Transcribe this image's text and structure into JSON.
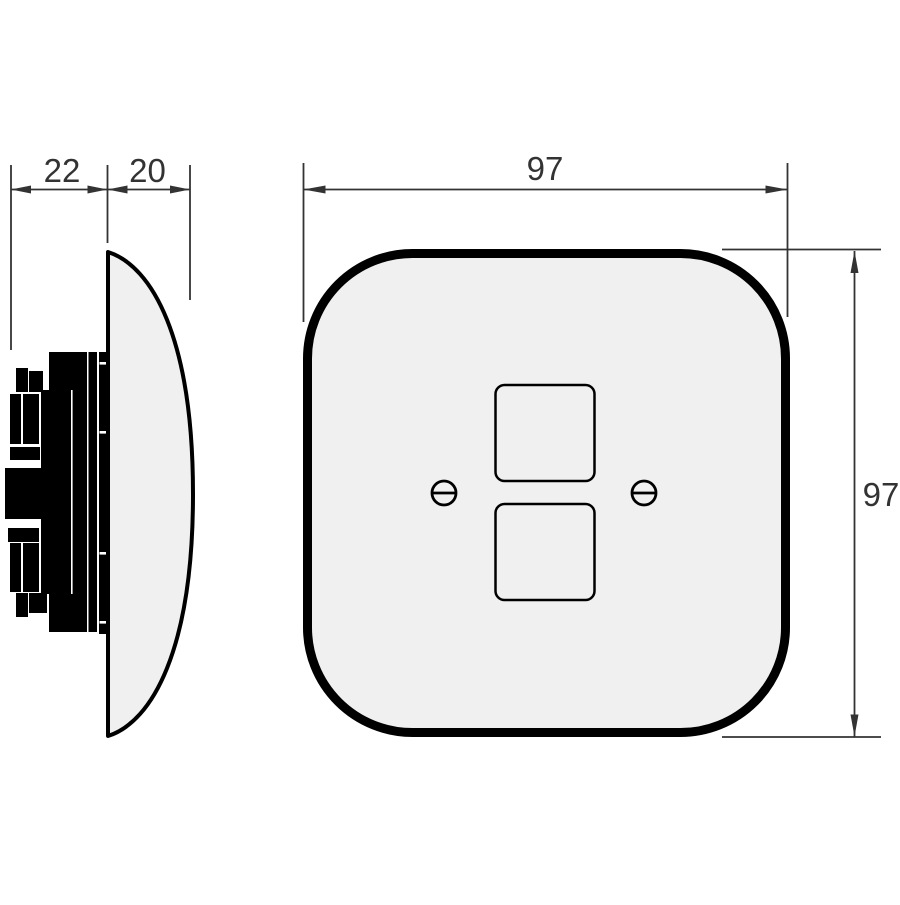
{
  "colors": {
    "outline": "#000000",
    "dimension": "#333333",
    "plate_fill": "#f0f0f0",
    "mechanism_fill": "#000000",
    "background": "#ffffff"
  },
  "dimensions": {
    "mechanism_depth": {
      "label": "22"
    },
    "plate_depth": {
      "label": "20"
    },
    "plate_width": {
      "label": "97"
    },
    "plate_height": {
      "label": "97"
    }
  }
}
